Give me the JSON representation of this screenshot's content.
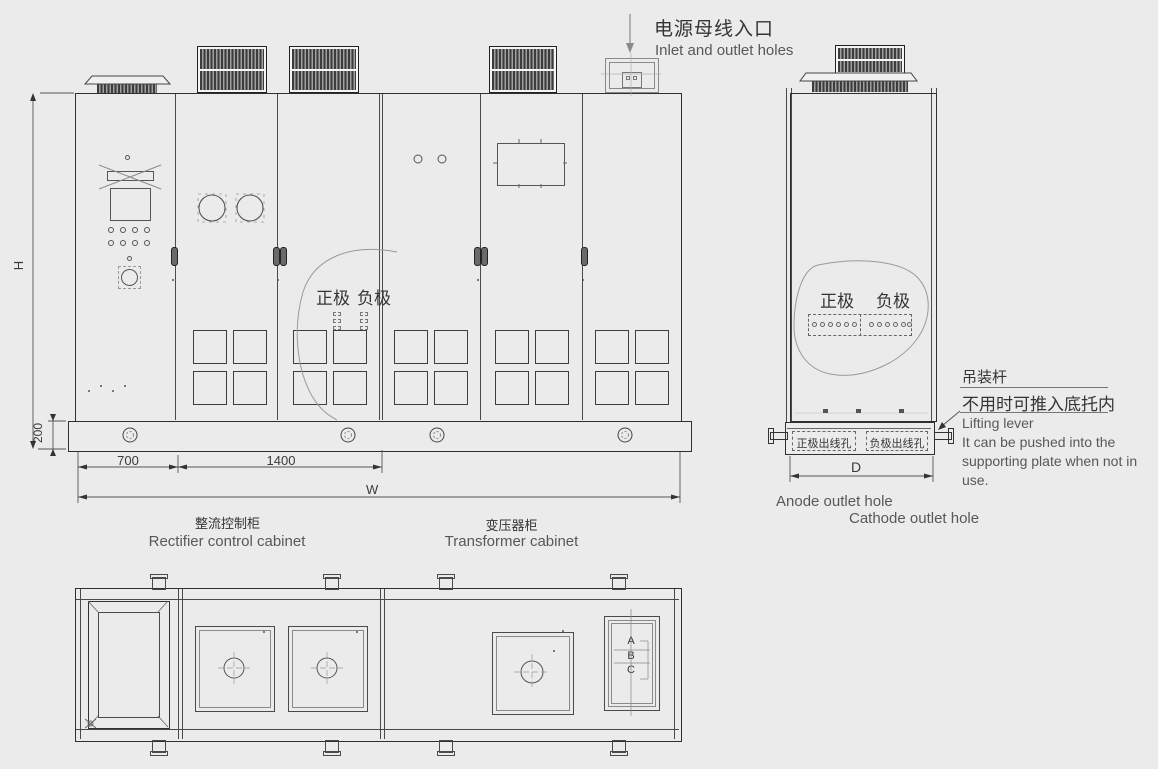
{
  "inlet": {
    "zh": "电源母线入口",
    "en": "Inlet and outlet holes"
  },
  "front": {
    "bubble": {
      "anode": "正极",
      "cathode": "负极"
    }
  },
  "side": {
    "bubble": {
      "anode": "正极",
      "cathode": "负极"
    }
  },
  "dims": {
    "height_label": "H",
    "base_height": "200",
    "rectifier_width": "700",
    "transformer_width": "1400",
    "total_width": "W",
    "depth": "D"
  },
  "cabinets": {
    "rectifier": {
      "zh": "整流控制柜",
      "en": "Rectifier control cabinet"
    },
    "transformer": {
      "zh": "变压器柜",
      "en": "Transformer cabinet"
    }
  },
  "outlets": {
    "anode_zh": "正极出线孔",
    "cathode_zh": "负极出线孔",
    "anode_en": "Anode outlet hole",
    "cathode_en": "Cathode outlet hole"
  },
  "lifting": {
    "zh_title": "吊装杆",
    "zh_note": "不用时可推入底托内",
    "en_title": "Lifting lever",
    "en_note": "It can be pushed into the supporting plate when not in use."
  },
  "plan": {
    "sections": [
      "A",
      "B",
      "C"
    ]
  },
  "colors": {
    "background": "#ebebeb",
    "line": "#3f3f3f",
    "grille": "#3c3c3c",
    "text_gray": "#585858"
  }
}
